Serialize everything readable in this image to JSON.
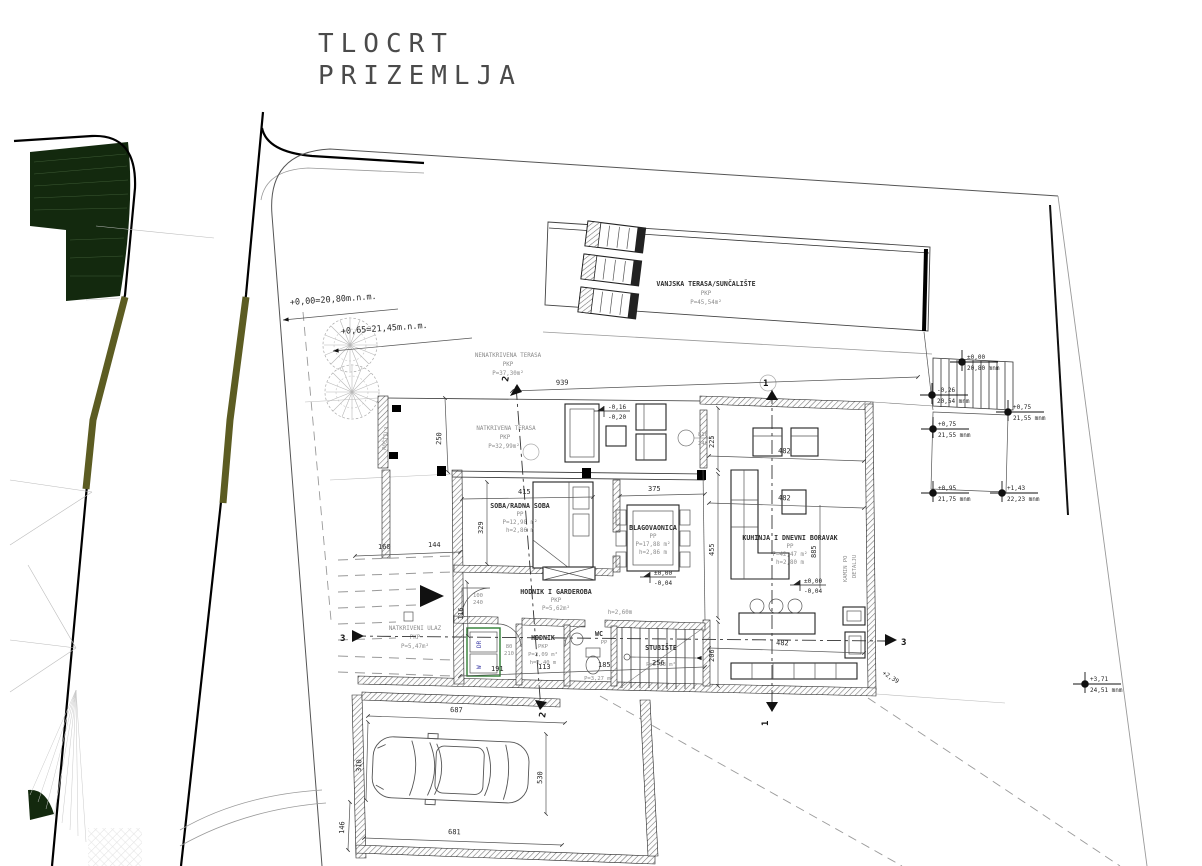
{
  "title": {
    "line1": "TLOCRT",
    "line2": "PRIZEMLJA"
  },
  "site": {
    "benchmark1": "+0,00=20,80m.n.m.",
    "benchmark2": "+0,65=21,45m.n.m.",
    "slope_label": "+2,39",
    "spot_elevations": [
      {
        "level": "±0,00",
        "altitude": "20,80 mnm"
      },
      {
        "level": "-0,26",
        "altitude": "20,54 mnm"
      },
      {
        "level": "+0,75",
        "altitude": "21,55 mnm"
      },
      {
        "level": "+0,75",
        "altitude": "21,55 mnm"
      },
      {
        "level": "+0,95",
        "altitude": "21,75 mnm"
      },
      {
        "level": "+1,43",
        "altitude": "22,23 mnm"
      },
      {
        "level": "+3,71",
        "altitude": "24,51 mnm"
      }
    ]
  },
  "levels": {
    "terrace": {
      "a": "-0,16",
      "b": "-0,20"
    },
    "floor1": {
      "a": "±0,00",
      "b": "-0,04"
    },
    "floor2": {
      "a": "±0,00",
      "b": "-0,04"
    }
  },
  "rooms": {
    "vanjska_terasa": {
      "name": "VANJSKA TERASA/SUNČALIŠTE",
      "code": "PKP",
      "area": "P=45,54m²"
    },
    "nenatkrivena_terasa": {
      "name": "NENATKRIVENA TERASA",
      "code": "PKP",
      "area": "P=37,30m²"
    },
    "natkrivena_terasa": {
      "name": "NATKRIVENA TERASA",
      "code": "PKP",
      "area": "P=32,99m²"
    },
    "rostilj": {
      "name": "ROŠTILJ"
    },
    "natkriveni_ulaz": {
      "name": "NATKRIVENI ULAZ",
      "code": "PKP",
      "area": "P=5,47m²"
    },
    "soba": {
      "name": "SOBA/RADNA SOBA",
      "code": "PP",
      "area": "P=12,98 m²",
      "height": "h=2,86 m"
    },
    "blagovaonica": {
      "name": "BLAGOVAONICA",
      "code": "PP",
      "area": "P=17,88 m²",
      "height": "h=2,86 m"
    },
    "kuhinja": {
      "name": "KUHINJA I DNEVNI BORAVAK",
      "code": "PP",
      "area": "P=42,47 m²",
      "height": "h=2,80 m"
    },
    "hodnik_garderoba": {
      "name": "HODNIK I GARDEROBA",
      "code": "PKP",
      "area": "P=5,62m²",
      "height": "h=2,60m"
    },
    "hodnik": {
      "name": "HODNIK",
      "code": "PKP",
      "area": "P=2,09 m²",
      "height": "h=2,40 m"
    },
    "wc": {
      "name": "WC",
      "code": "PP",
      "area": "P=3,27 m²",
      "height": "h=2,40 m"
    },
    "stubiste": {
      "name": "STUBIŠTE",
      "area": "P=5,83 m²"
    },
    "kamin": {
      "line1": "KAMIN PO",
      "line2": "DETALJU"
    }
  },
  "appliances": {
    "dryer": "DR",
    "washer": "W"
  },
  "dims": {
    "d939": "939",
    "d250": "250",
    "d415": "415",
    "d375": "375",
    "d329": "329",
    "d225": "225",
    "d455": "455",
    "d206": "206",
    "d885": "885",
    "d482a": "482",
    "d482b": "482",
    "d482c": "482",
    "d160": "160",
    "d144": "144",
    "d116": "116",
    "d191": "191",
    "d113": "113",
    "d185": "185",
    "d256": "256",
    "d687": "687",
    "d681": "681",
    "d310": "310",
    "d530": "530",
    "d146": "146",
    "door1w": "100",
    "door1h": "240",
    "door2w": "80",
    "door2h": "210",
    "win1w": "810",
    "win1h": "240"
  },
  "sections": {
    "s1": "1",
    "s2": "2",
    "s3": "3"
  }
}
